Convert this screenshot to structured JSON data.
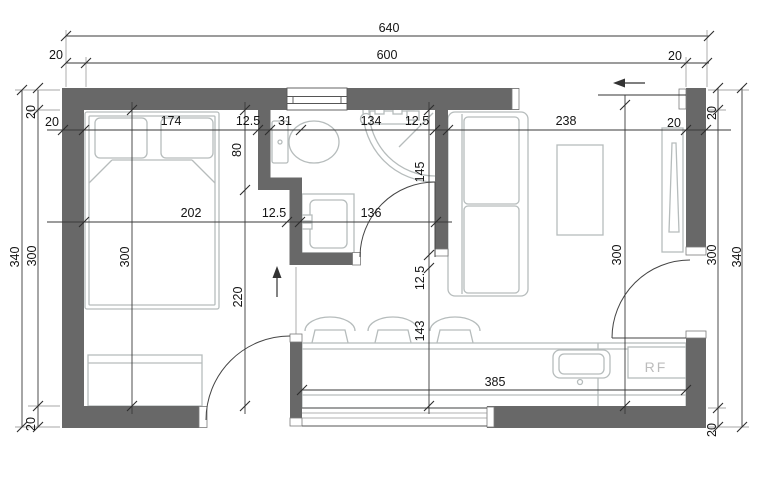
{
  "dims": {
    "top_total": "640",
    "top_wall_left": "20",
    "top_inner": "600",
    "top_wall_right": "20",
    "left_total": "340",
    "left_wall_top": "20",
    "left_inner": "300",
    "left_wall_bottom": "20",
    "right_total": "340",
    "right_wall_top": "20",
    "right_inner": "300",
    "right_wall_bottom": "20",
    "row1_wall_left": "20",
    "row1_bed": "174",
    "row1_partition": "12.5",
    "row1_recess": "31",
    "row1_bath": "134",
    "row1_bath_wall": "12.5",
    "row1_living": "238",
    "row1_wall_right": "20",
    "row2_bedroom": "202",
    "row2_partition": "12.5",
    "row2_bath_lower": "136",
    "col_bedroom": "300",
    "col_partition_upper": "80",
    "col_bedroom_lower": "220",
    "col_bath": "145",
    "col_bath_wall": "12.5",
    "col_entry": "143",
    "col_living": "300",
    "counter_length": "385"
  },
  "labels": {
    "refrigerator": "RF"
  },
  "colors": {
    "wall_fill": "#686868",
    "furniture_line": "#b6bcbc",
    "dimension_line": "#3a3a3a",
    "label_text": "#141414",
    "fixture_text": "#bcbcbc"
  }
}
